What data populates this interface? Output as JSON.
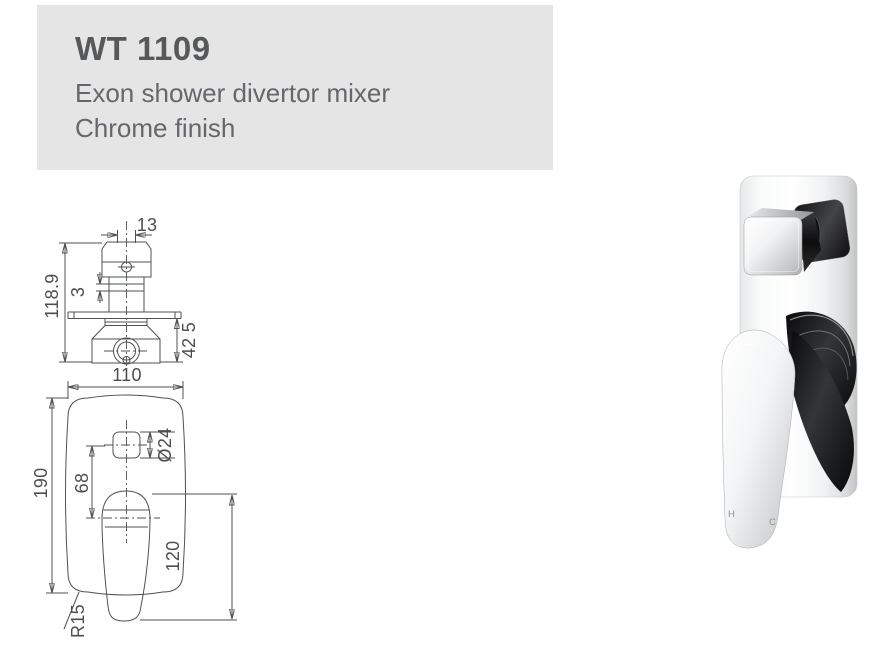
{
  "header": {
    "model": "WT 1109",
    "description_line1": "Exon shower divertor mixer",
    "description_line2": "Chrome finish",
    "bg_color": "#e5e5e6",
    "title_color": "#57585a"
  },
  "technical_drawing": {
    "line_color": "#4f5052",
    "top_view": {
      "labels": {
        "spindle_width": "13",
        "plate_gap": "3",
        "total_height": "118.9",
        "body_depth": "42 5"
      }
    },
    "front_view": {
      "labels": {
        "plate_width": "110",
        "plate_height": "190",
        "button_offset": "68",
        "button_diameter": "Ø24",
        "handle_length": "120",
        "corner_radius": "R15"
      }
    }
  },
  "product_photo": {
    "hot_marking": "H",
    "cold_marking": "C"
  }
}
